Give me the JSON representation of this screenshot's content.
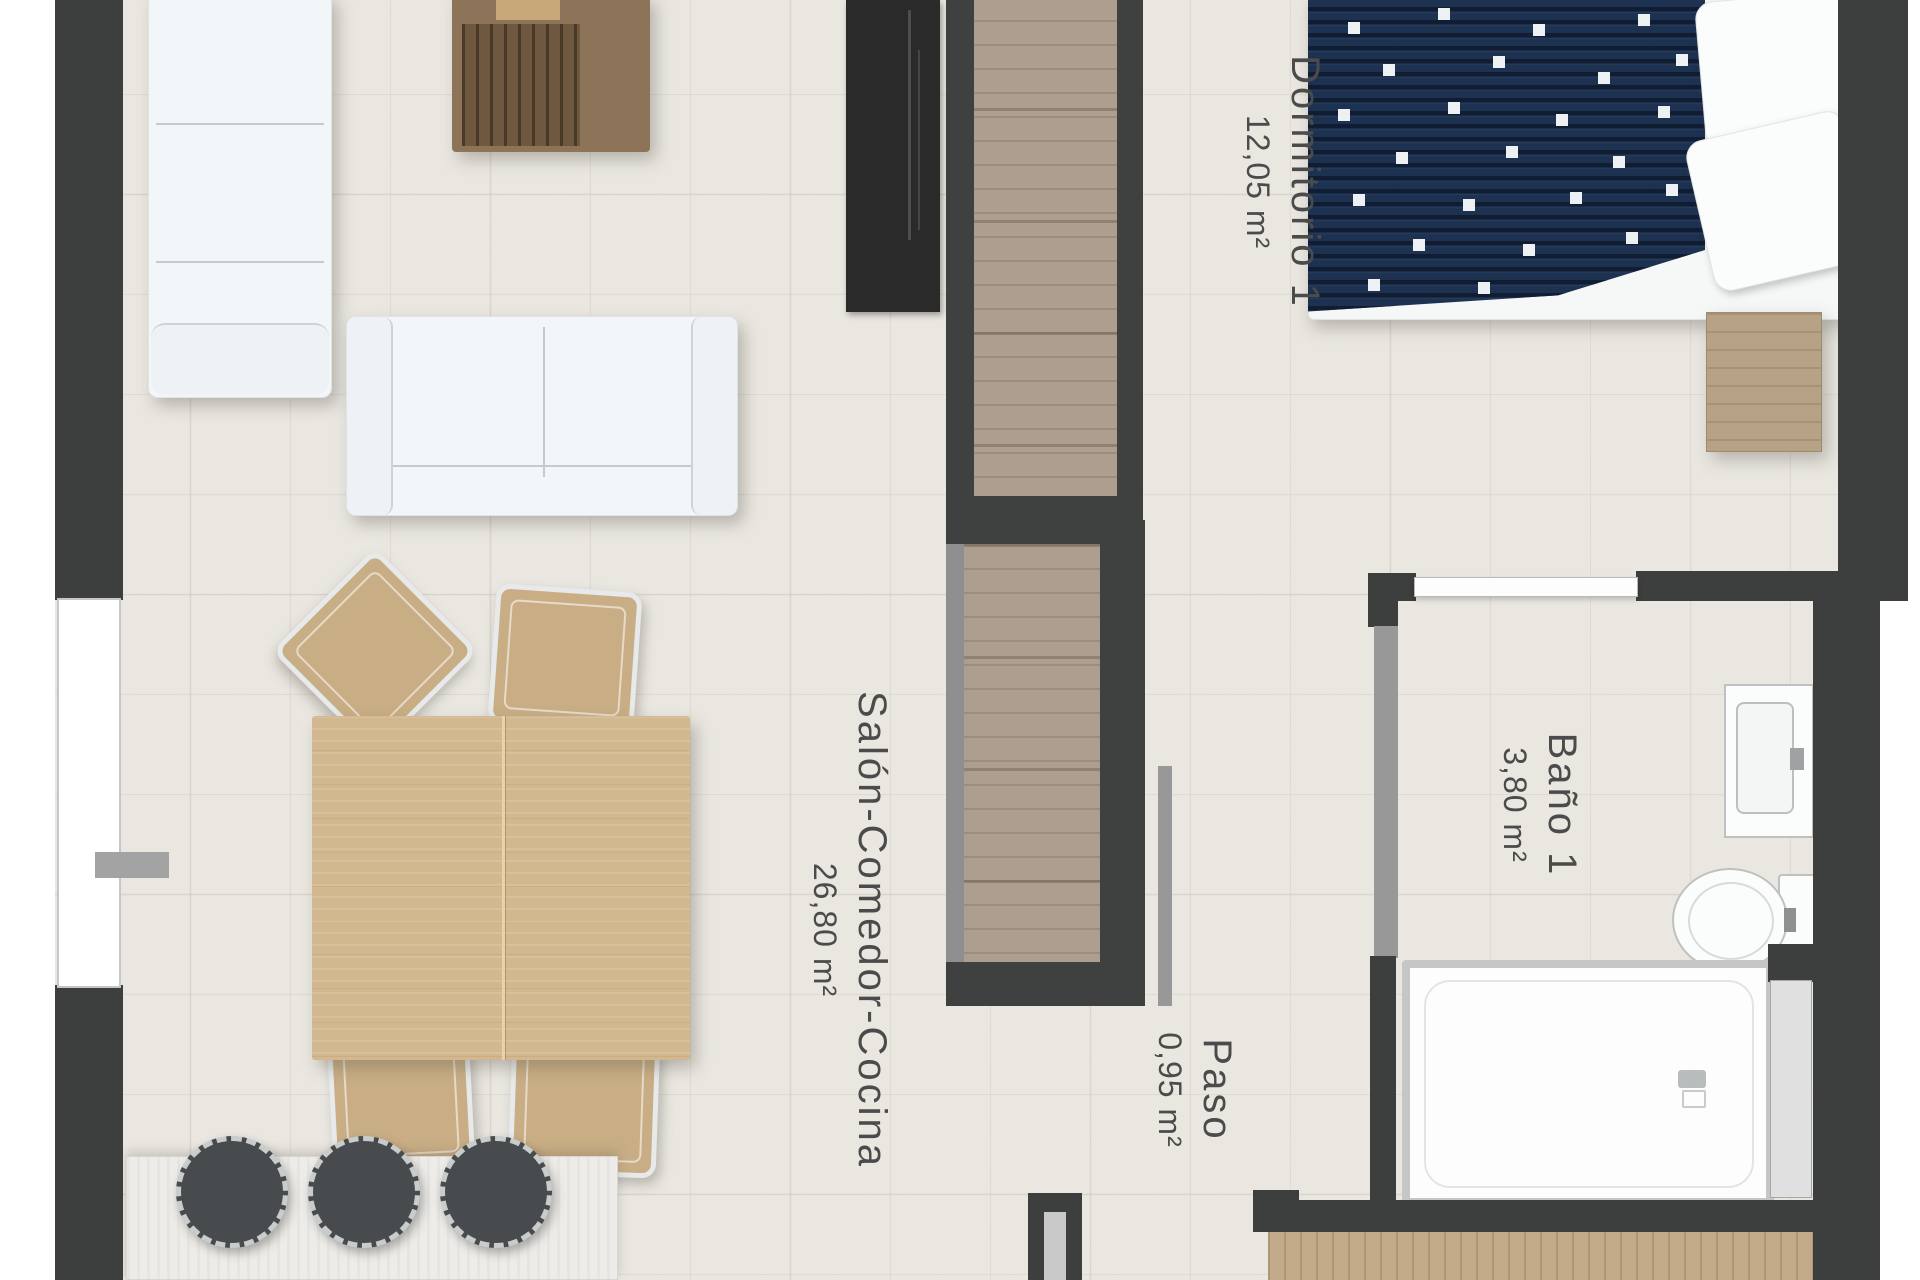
{
  "plan": {
    "rooms": [
      {
        "name": "Salón-Comedor-Cocina",
        "area": "26,80 m²"
      },
      {
        "name": "Dormitorio 1",
        "area": "12,05 m²"
      },
      {
        "name": "Baño 1",
        "area": "3,80 m²"
      },
      {
        "name": "Paso",
        "area": "0,95 m²"
      }
    ],
    "colors": {
      "wall": "#3d3e3e",
      "light_wall": "#989898",
      "floor": "#eae7e1",
      "cabinet_wood": "#ad9e8f",
      "table_wood": "#d3b78e",
      "bed_duvet": "#1d3150",
      "fixture_outline": "#c6c6c6"
    }
  }
}
